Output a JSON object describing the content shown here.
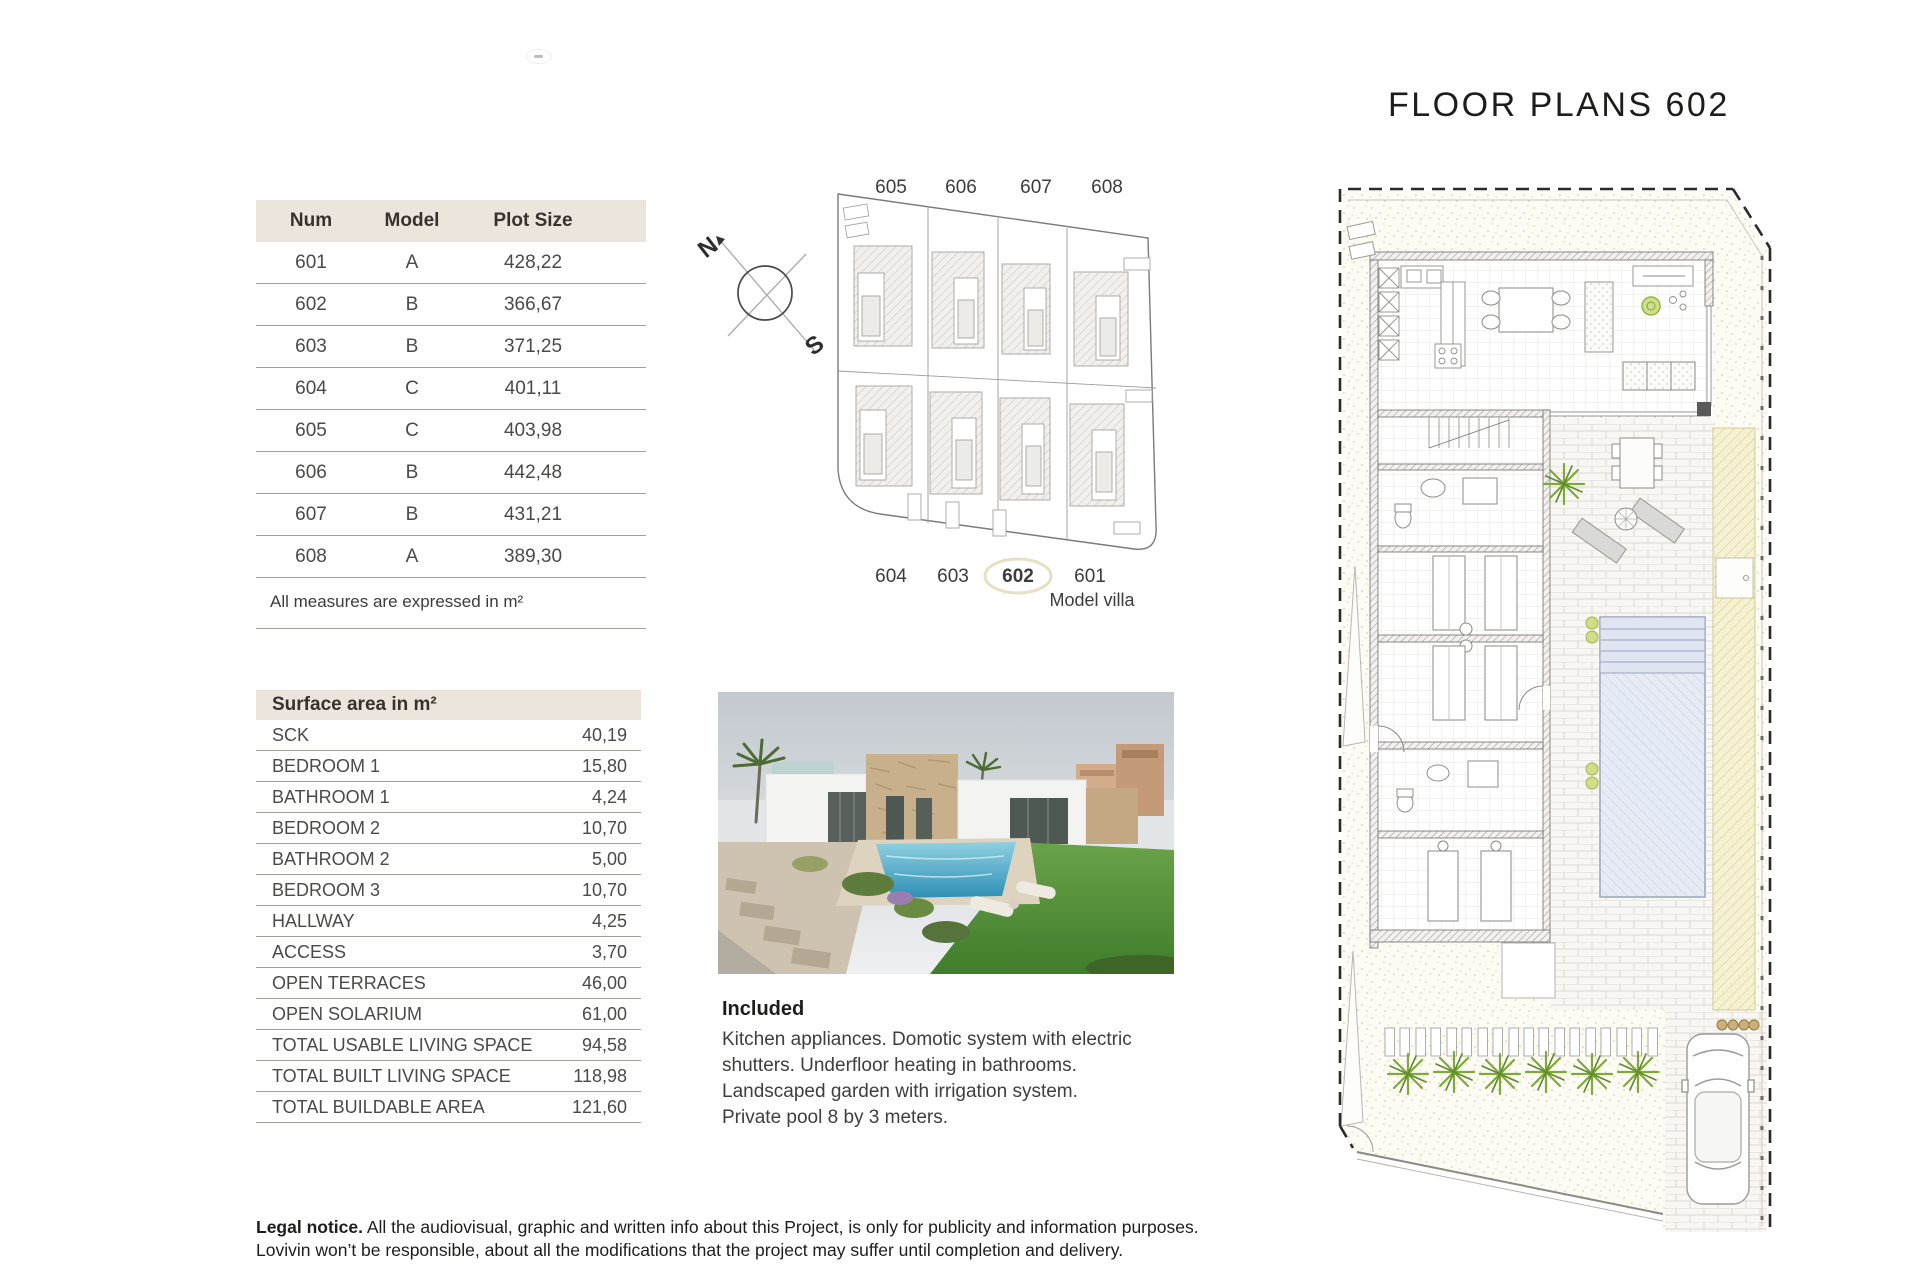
{
  "page": {
    "title": "FLOOR PLANS 602"
  },
  "plots_table": {
    "headers": [
      "Num",
      "Model",
      "Plot Size"
    ],
    "rows": [
      {
        "num": "601",
        "model": "A",
        "plot": "428,22"
      },
      {
        "num": "602",
        "model": "B",
        "plot": "366,67"
      },
      {
        "num": "603",
        "model": "B",
        "plot": "371,25"
      },
      {
        "num": "604",
        "model": "C",
        "plot": "401,11"
      },
      {
        "num": "605",
        "model": "C",
        "plot": "403,98"
      },
      {
        "num": "606",
        "model": "B",
        "plot": "442,48"
      },
      {
        "num": "607",
        "model": "B",
        "plot": "431,21"
      },
      {
        "num": "608",
        "model": "A",
        "plot": "389,30"
      }
    ],
    "note": "All measures are expressed in m²"
  },
  "surface_table": {
    "title": "Surface area in m²",
    "rows": [
      {
        "label": "SCK",
        "value": "40,19"
      },
      {
        "label": "BEDROOM 1",
        "value": "15,80"
      },
      {
        "label": "BATHROOM 1",
        "value": "4,24"
      },
      {
        "label": "BEDROOM 2",
        "value": "10,70"
      },
      {
        "label": "BATHROOM 2",
        "value": "5,00"
      },
      {
        "label": "BEDROOM 3",
        "value": "10,70"
      },
      {
        "label": "HALLWAY",
        "value": "4,25"
      },
      {
        "label": "ACCESS",
        "value": "3,70"
      },
      {
        "label": "OPEN TERRACES",
        "value": "46,00"
      },
      {
        "label": "OPEN SOLARIUM",
        "value": "61,00"
      },
      {
        "label": "TOTAL USABLE LIVING SPACE",
        "value": "94,58"
      },
      {
        "label": "TOTAL BUILT LIVING SPACE",
        "value": "118,98"
      },
      {
        "label": "TOTAL BUILDABLE AREA",
        "value": "121,60"
      }
    ]
  },
  "site_plan": {
    "top_labels": [
      "605",
      "606",
      "607",
      "608"
    ],
    "bottom_labels": [
      "604",
      "603",
      "602",
      "601"
    ],
    "highlighted": "602",
    "model_villa_label": "Model villa",
    "compass": {
      "north": "N",
      "south": "S"
    }
  },
  "included": {
    "heading": "Included",
    "body": "Kitchen appliances. Domotic system with electric\nshutters. Underfloor heating in bathrooms.\nLandscaped garden with irrigation system.\nPrivate pool 8 by 3 meters."
  },
  "legal": {
    "label": "Legal notice.",
    "text": " All the audiovisual, graphic and written info about this Project, is only for publicity and information purposes.\nLovivin won’t be responsible, about all the modifications that the project may suffer until completion and delivery."
  },
  "colors": {
    "table_header_beige": "#ece5dc",
    "pool_blue": "#e3e9f4",
    "plant_green": "#7fa83d",
    "solarium_yellow": "#f5f1d3"
  }
}
